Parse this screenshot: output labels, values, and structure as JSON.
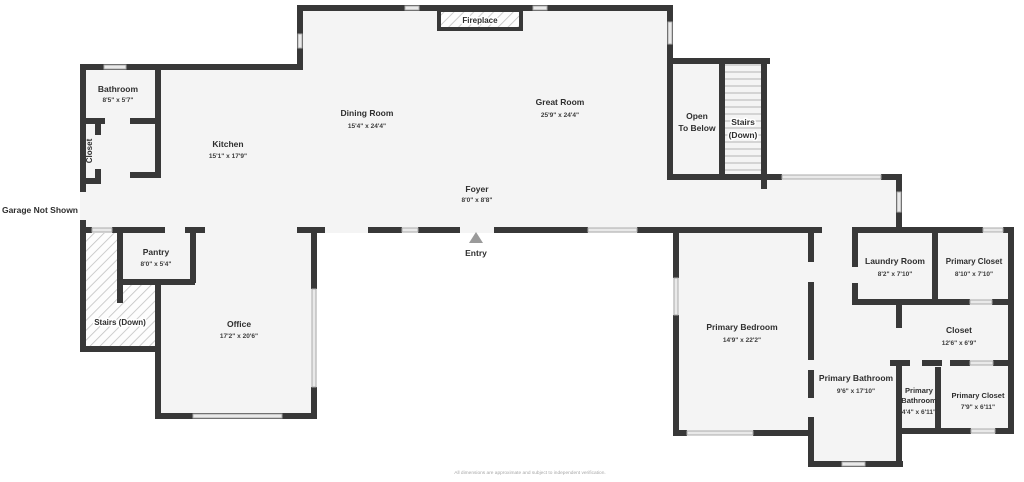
{
  "canvas": {
    "background": "#ffffff",
    "wall_color": "#383838",
    "floor_color": "#f4f4f4",
    "window_color": "#e9e9e9",
    "entry_arrow_color": "#9a9a9a"
  },
  "labels": {
    "garage_note": "Garage Not Shown",
    "entry": "Entry",
    "fireplace": "Fireplace",
    "open_to_below_1": "Open",
    "open_to_below_2": "To Below",
    "stairs_upper_1": "Stairs",
    "stairs_upper_2": "(Down)",
    "stairs_lower": "Stairs (Down)",
    "disclaimer": "All dimensions are approximate and subject to independent verification."
  },
  "rooms": {
    "bathroom": {
      "name": "Bathroom",
      "dims": "8'5\" x 5'7\""
    },
    "hall_closet": {
      "name": "Closet"
    },
    "kitchen": {
      "name": "Kitchen",
      "dims": "15'1\" x 17'9\""
    },
    "dining_room": {
      "name": "Dining Room",
      "dims": "15'4\" x 24'4\""
    },
    "great_room": {
      "name": "Great Room",
      "dims": "25'9\" x 24'4\""
    },
    "foyer": {
      "name": "Foyer",
      "dims": "8'0\" x 8'8\""
    },
    "pantry": {
      "name": "Pantry",
      "dims": "8'0\" x 5'4\""
    },
    "office": {
      "name": "Office",
      "dims": "17'2\" x 20'6\""
    },
    "primary_bedroom": {
      "name": "Primary Bedroom",
      "dims": "14'9\" x 22'2\""
    },
    "laundry_room": {
      "name": "Laundry Room",
      "dims": "8'2\" x 7'10\""
    },
    "primary_closet_upper": {
      "name": "Primary Closet",
      "dims": "8'10\" x 7'10\""
    },
    "suite_closet": {
      "name": "Closet",
      "dims": "12'6\" x 6'9\""
    },
    "primary_bathroom": {
      "name": "Primary Bathroom",
      "dims": "9'6\" x 17'10\""
    },
    "primary_bathroom_small": {
      "name_1": "Primary",
      "name_2": "Bathroom",
      "dims": "4'4\" x 6'11\""
    },
    "primary_closet_lower": {
      "name": "Primary Closet",
      "dims": "7'9\" x 6'11\""
    }
  }
}
